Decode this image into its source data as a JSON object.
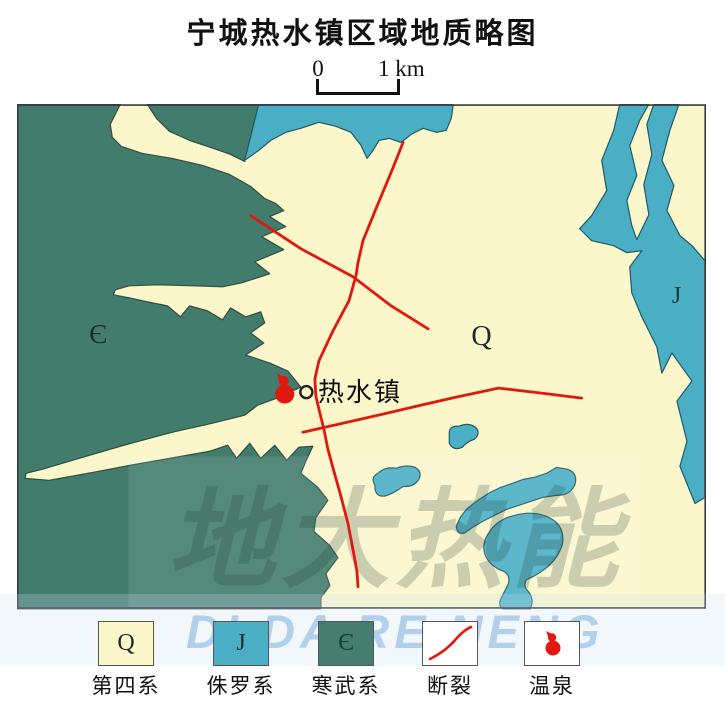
{
  "title": "宁城热水镇区域地质略图",
  "scale_bar": {
    "zero": "0",
    "one_km": "1 km"
  },
  "map": {
    "labels": {
      "cambrian": "Є",
      "quaternary": "Q",
      "jurassic": "J",
      "town": "热水镇"
    },
    "colors": {
      "quaternary_fill": "#FBF7CB",
      "jurassic_fill": "#4AAFC5",
      "cambrian_fill": "#417C6D",
      "fault_red": "#E0190F",
      "region_outline": "#2F4F45",
      "map_border": "#3a3a3a"
    },
    "features": {
      "town_marker": "热水镇",
      "hot_spring_present": true,
      "fault_count": 3
    }
  },
  "legend": {
    "items": [
      {
        "symbol": "Q",
        "label": "第四系",
        "type": "fill",
        "color": "#FBF7CB"
      },
      {
        "symbol": "J",
        "label": "侏罗系",
        "type": "fill",
        "color": "#4AAFC5"
      },
      {
        "symbol": "Є",
        "label": "寒武系",
        "type": "fill",
        "color": "#457D6E"
      },
      {
        "symbol": "",
        "label": "断裂",
        "type": "fault-line",
        "color": "#E0190F"
      },
      {
        "symbol": "",
        "label": "温泉",
        "type": "hot-spring",
        "color": "#E0190F"
      }
    ]
  },
  "watermark": {
    "cn": "地大热能",
    "en": "DI DA RE NENG"
  },
  "chart_data": {
    "type": "table",
    "title": "宁城热水镇区域地质略图",
    "description": "regional geological sketch map",
    "units": [
      {
        "code": "Q",
        "name": "第四系",
        "extent": "central and eastern plain of map"
      },
      {
        "code": "J",
        "name": "侏罗系",
        "extent": "top-center patch, eastern margin band, scattered blobs in south-center"
      },
      {
        "code": "Є",
        "name": "寒武系",
        "extent": "western mass with Q valleys cutting in"
      }
    ],
    "faults": 3,
    "hot_springs": [
      {
        "name": "热水镇温泉",
        "location": "at Є/Q boundary west of 热水镇 town symbol"
      }
    ],
    "scale": "0–1 km bar"
  }
}
